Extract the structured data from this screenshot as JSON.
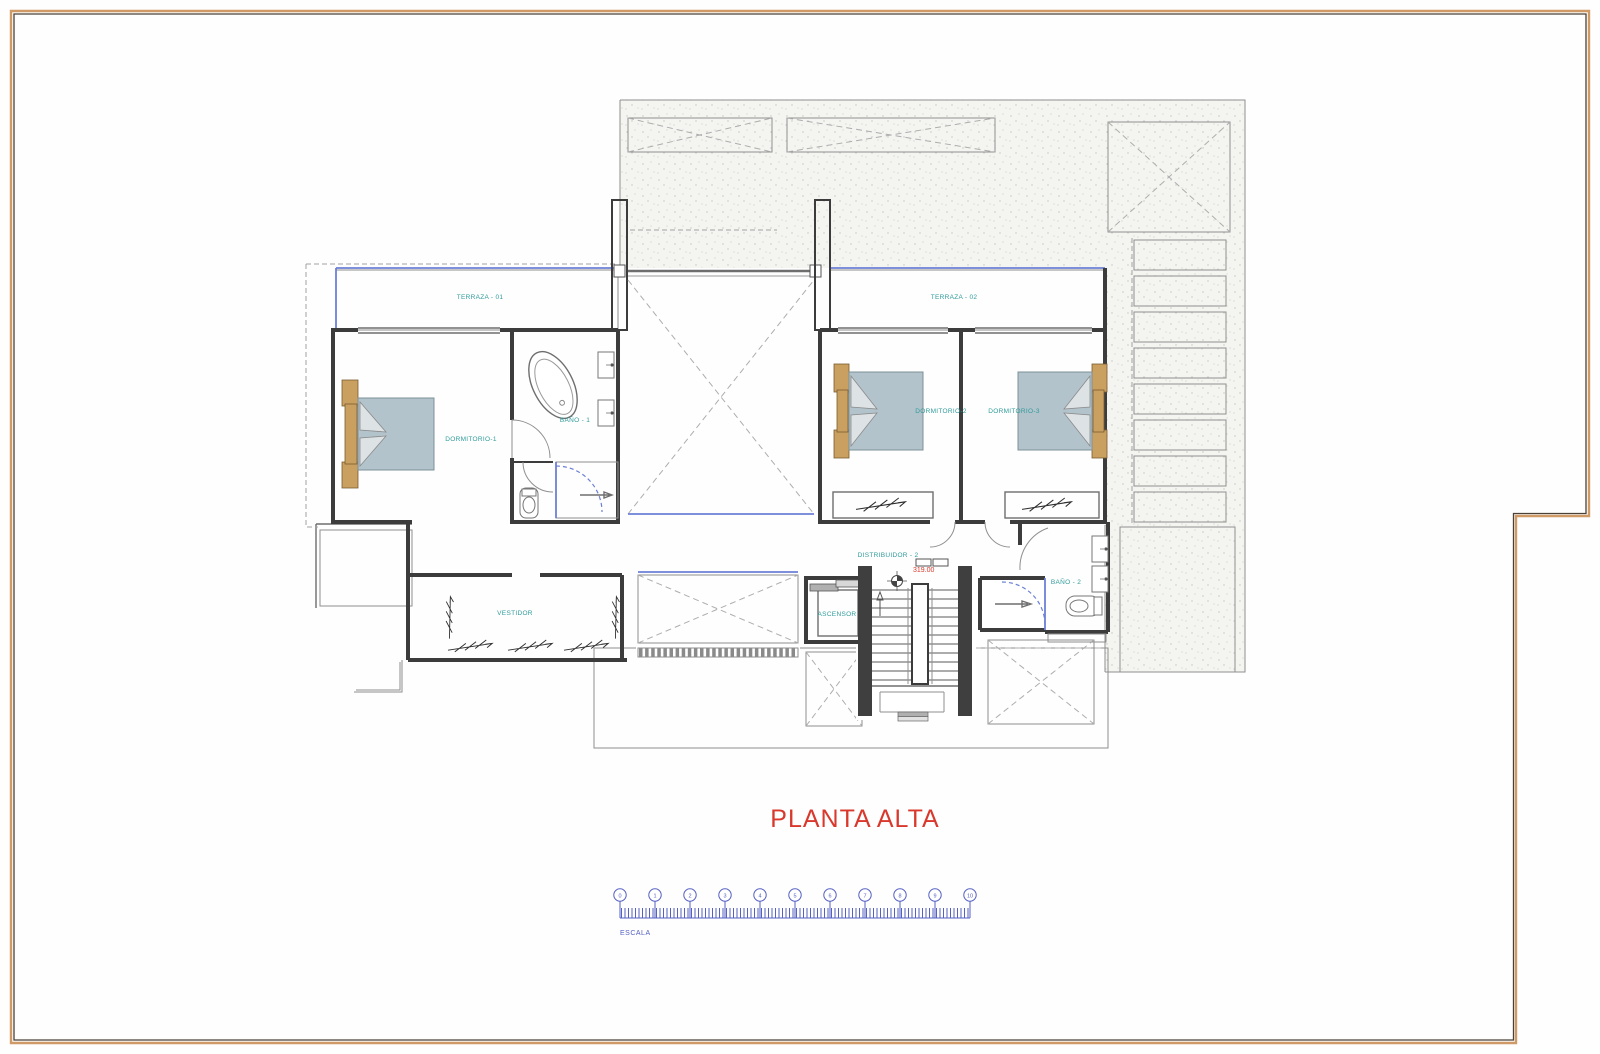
{
  "page": {
    "title": "PLANTA ALTA"
  },
  "plan": {
    "rooms": {
      "terraza1": "TERRAZA - 01",
      "terraza2": "TERRAZA - 02",
      "dormitorio1": "DORMITORIO-1",
      "bano1": "BAÑO - 1",
      "dormitorio2": "DORMITORIO-2",
      "dormitorio3": "DORMITORIO-3",
      "vestidor": "VESTIDOR",
      "distribuidor": "DISTRIBUIDOR - 2",
      "ascensor": "ASCENSOR",
      "bano2": "BAÑO - 2"
    },
    "level_mark": "319.00"
  },
  "scale_bar": {
    "label": "ESCALA",
    "ticks": [
      "0",
      "1",
      "2",
      "3",
      "4",
      "5",
      "6",
      "7",
      "8",
      "9",
      "10"
    ]
  },
  "colors": {
    "title_red": "#d9382c",
    "label_teal": "#2f9b9b",
    "scale_blue": "#5560c4",
    "glass_blue": "#6b7fd7",
    "deck_tan": "#b5804c",
    "wall_dark": "#3c3c3c",
    "frame_tan": "#cf9a66"
  }
}
